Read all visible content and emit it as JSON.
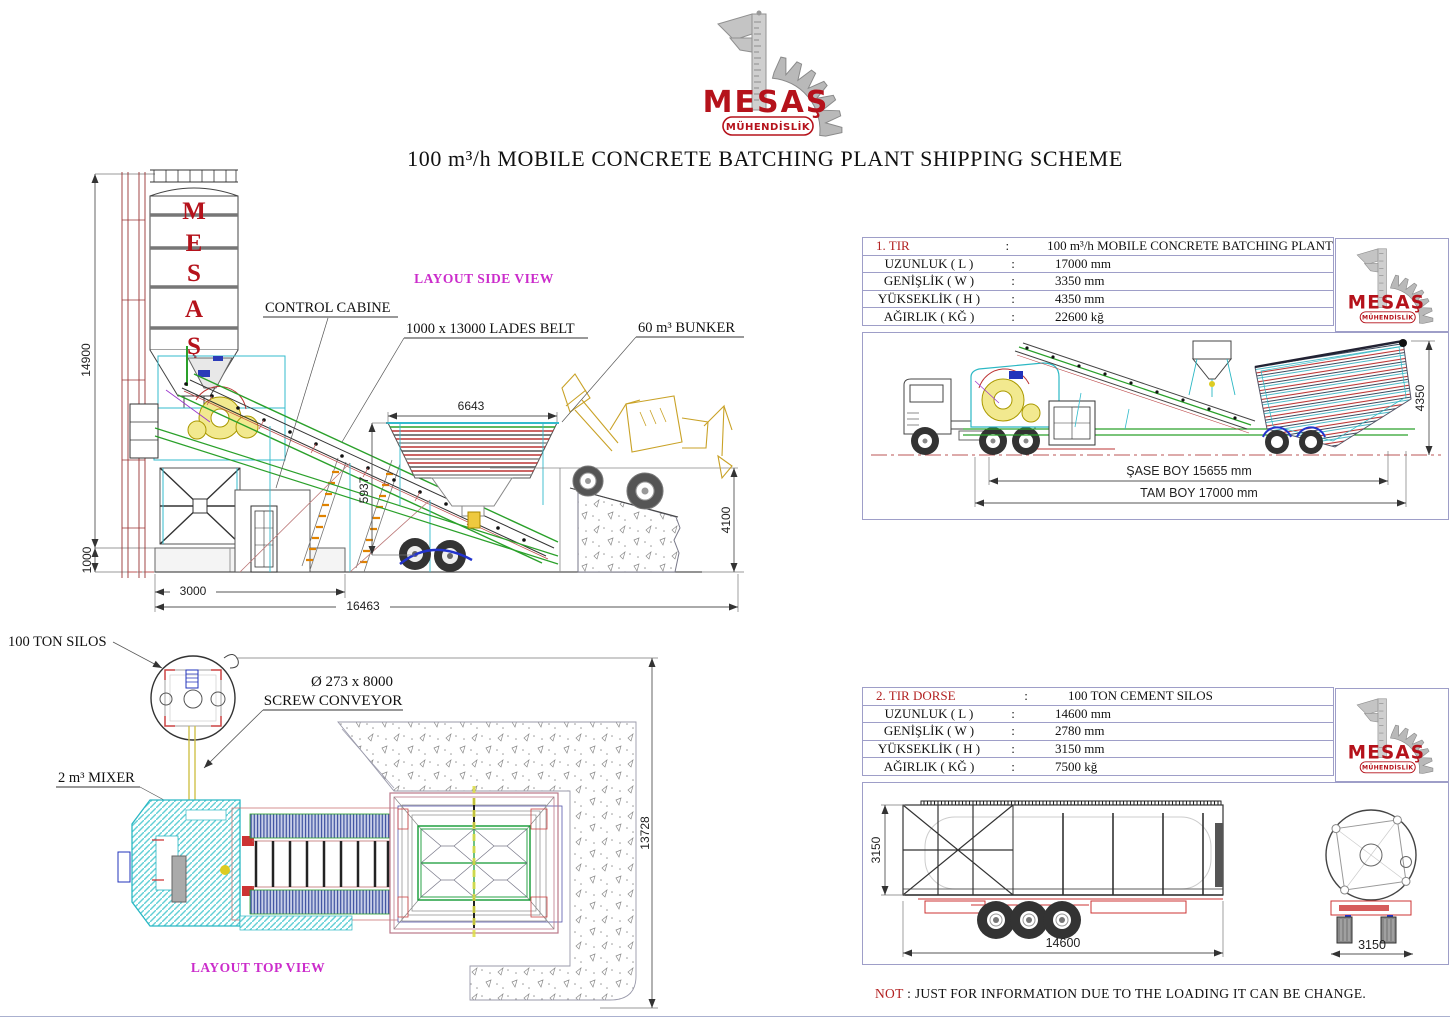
{
  "logo": {
    "name": "MESAŞ",
    "subtitle": "MÜHENDİSLİK"
  },
  "title": "100 m³/h MOBILE CONCRETE BATCHING PLANT SHIPPING SCHEME",
  "colors": {
    "brand_red": "#b5121b",
    "highlight_red": "#b22020",
    "caption_magenta": "#cb2ccb",
    "panel_border": "#9e9ec8"
  },
  "side_view": {
    "caption": "LAYOUT SIDE VIEW",
    "silo_letters": [
      "M",
      "E",
      "S",
      "A",
      "Ş"
    ],
    "labels": {
      "control_cabin": "CONTROL CABINE",
      "lades_belt": "1000 x 13000 LADES BELT",
      "bunker": "60 m³ BUNKER"
    },
    "dims": {
      "silo_height": "14900",
      "base_height": "1000",
      "base_length": "3000",
      "total_length": "16463",
      "bunker_width": "6643",
      "bunker_height": "5937",
      "ramp_height": "4100"
    }
  },
  "top_view": {
    "caption": "LAYOUT TOP VIEW",
    "labels": {
      "silos": "100 TON SILOS",
      "screw_size": "Ø 273 x 8000",
      "screw_name": "SCREW CONVEYOR",
      "mixer": "2 m³ MIXER"
    },
    "dims": {
      "total_depth": "13728"
    }
  },
  "shipment1": {
    "table": {
      "rows": [
        {
          "label": "1. TIR",
          "colon": ":",
          "value": "100 m³/h MOBILE CONCRETE BATCHING PLANT"
        },
        {
          "label": "UZUNLUK ( L )",
          "colon": ":",
          "value": "17000 mm"
        },
        {
          "label": "GENİŞLİK ( W )",
          "colon": ":",
          "value": "3350 mm"
        },
        {
          "label": "YÜKSEKLİK ( H )",
          "colon": ":",
          "value": "4350 mm"
        },
        {
          "label": "AĞIRLIK ( KĞ )",
          "colon": ":",
          "value": "22600 kğ"
        }
      ]
    },
    "dims": {
      "chassis_length": "ŞASE BOY 15655 mm",
      "total_length": "TAM BOY 17000 mm",
      "height": "4350"
    }
  },
  "shipment2": {
    "table": {
      "rows": [
        {
          "label": "2. TIR DORSE",
          "colon": ":",
          "value": "100 TON CEMENT SILOS"
        },
        {
          "label": "UZUNLUK ( L )",
          "colon": ":",
          "value": "14600 mm"
        },
        {
          "label": "GENİŞLİK ( W )",
          "colon": ":",
          "value": "2780 mm"
        },
        {
          "label": "YÜKSEKLİK ( H )",
          "colon": ":",
          "value": "3150 mm"
        },
        {
          "label": "AĞIRLIK ( KĞ )",
          "colon": ":",
          "value": "7500 kğ"
        }
      ]
    },
    "dims": {
      "height": "3150",
      "length": "14600",
      "rear_width": "3150"
    }
  },
  "note": {
    "prefix": "NOT",
    "text": ": JUST FOR INFORMATION DUE TO THE LOADING IT CAN BE CHANGE."
  }
}
